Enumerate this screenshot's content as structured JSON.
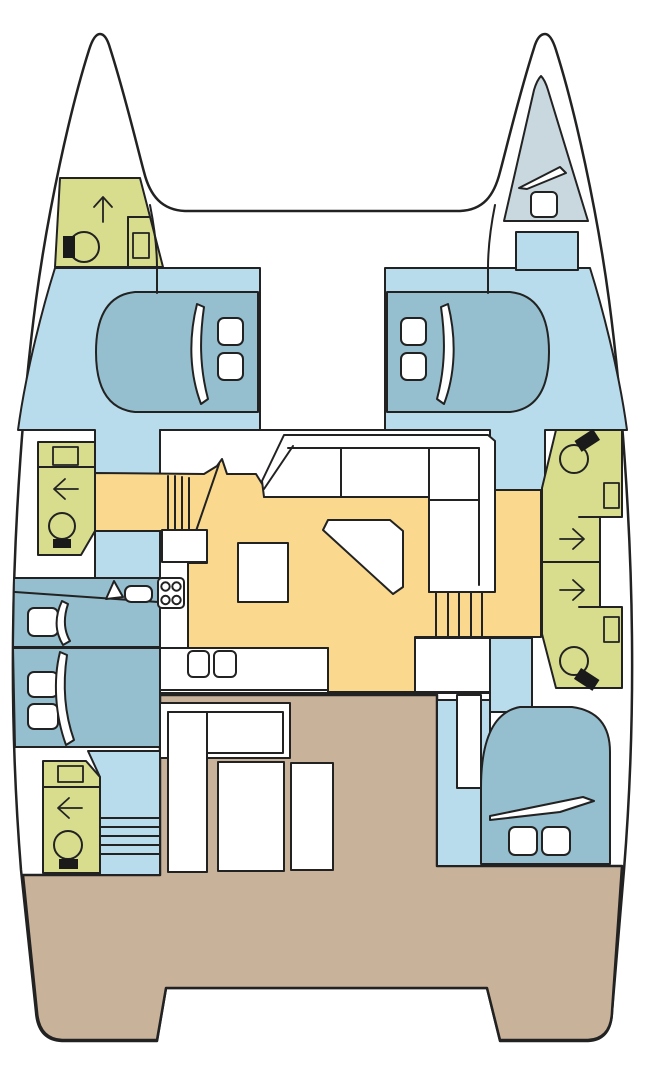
{
  "diagram": {
    "kind": "catamaran-deck-floorplan",
    "orientation": "bow-up",
    "visible_text": []
  },
  "palette": {
    "outline": "#222222",
    "hull_white": "#ffffff",
    "cabin_floor_blue": "#b9dcec",
    "berth_blue": "#95bfce",
    "bathroom_green": "#d7dd8d",
    "saloon_yellow": "#fad98f",
    "deck_tan": "#c9b29a",
    "forepeak_gray": "#c9d8de",
    "fixture_black": "#1a1a1a"
  },
  "rooms": [
    {
      "id": "port-bow-head",
      "label": "forward head in port bow",
      "color": "bathroom_green"
    },
    {
      "id": "starboard-forepeak-berth",
      "label": "forepeak berth in starboard bow",
      "color": "forepeak_gray"
    },
    {
      "id": "port-forward-cabin",
      "label": "port forward double cabin",
      "color": "cabin_floor_blue"
    },
    {
      "id": "starboard-forward-cabin",
      "label": "starboard forward double cabin",
      "color": "cabin_floor_blue"
    },
    {
      "id": "port-mid-head",
      "label": "port mid head with shower",
      "color": "bathroom_green"
    },
    {
      "id": "port-aft-cabin-berths",
      "label": "port aft cabin twin berths",
      "color": "berth_blue"
    },
    {
      "id": "port-aft-head",
      "label": "port aft head with shower",
      "color": "bathroom_green"
    },
    {
      "id": "saloon-galley",
      "label": "main-deck saloon and galley",
      "color": "saloon_yellow"
    },
    {
      "id": "starboard-forward-head",
      "label": "starboard forward head",
      "color": "bathroom_green"
    },
    {
      "id": "starboard-aft-head",
      "label": "starboard aft head",
      "color": "bathroom_green"
    },
    {
      "id": "starboard-aft-cabin",
      "label": "starboard aft double cabin",
      "color": "cabin_floor_blue"
    },
    {
      "id": "aft-cockpit",
      "label": "aft cockpit deck",
      "color": "deck_tan"
    }
  ],
  "fixtures": [
    "toilet-icon",
    "sink-icon",
    "shower-arrow-icon",
    "stove-4-burner-icon",
    "double-sink-icon",
    "l-sofa",
    "dinette-table",
    "galley-island",
    "companionway-stairs",
    "berth-pillow",
    "deck-hatch",
    "cockpit-bench",
    "cockpit-table"
  ]
}
